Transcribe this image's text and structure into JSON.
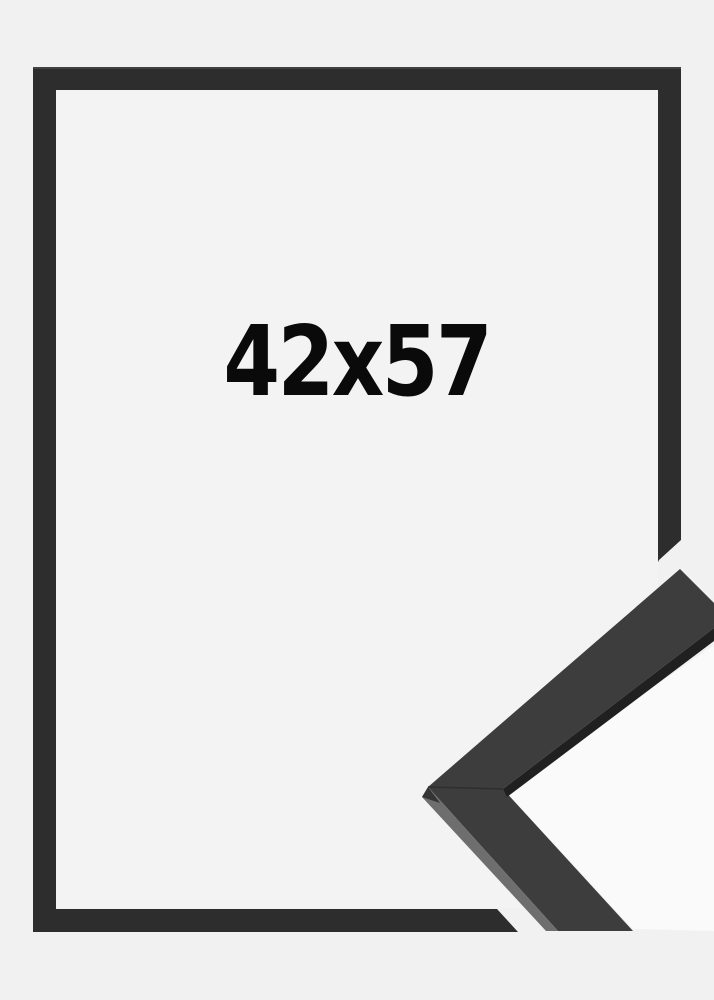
{
  "product": {
    "size_label": "42x57"
  },
  "image": {
    "subject": "empty black picture frame with magnified corner profile sample at lower right",
    "colors": {
      "page_background": "#f1f1f1",
      "frame_inner_background": "#f3f3f3",
      "frame_border": "#2d2d2d",
      "corner_sample_face": "#3d3d3d",
      "corner_sample_dark_edge": "#202020",
      "corner_sample_light_edge": "#6e6e6e",
      "corner_sample_backdrop": "#fafafa",
      "size_text": "#0a0a0a"
    }
  }
}
